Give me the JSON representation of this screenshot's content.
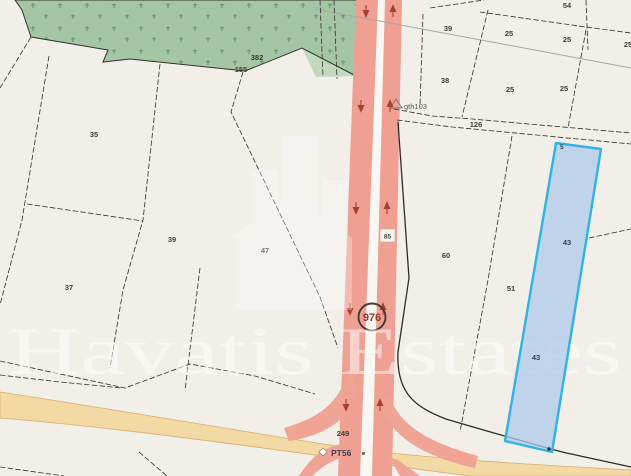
{
  "background_color": "#f2efe8",
  "watermark": {
    "text": "Havatis Estates"
  },
  "forest": {
    "area_number": "382",
    "boundary_number": "155",
    "color": "#a5c6a4"
  },
  "roads": {
    "route_badge": "976",
    "lane_ref": "85",
    "road_point_label": "PT56",
    "road_number": "249",
    "vertical_road_color": "#efa092",
    "horizontal_road_color": "#f3d9a4"
  },
  "survey": {
    "marker_label": "gth103"
  },
  "highlight": {
    "upper_number": "43",
    "lower_number": "43",
    "corner_number": "5",
    "fill": "#aecbec",
    "border": "#2fb3e6"
  },
  "parcels": [
    {
      "n": "35"
    },
    {
      "n": "39"
    },
    {
      "n": "47"
    },
    {
      "n": "37"
    },
    {
      "n": "54"
    },
    {
      "n": "39"
    },
    {
      "n": "25"
    },
    {
      "n": "25"
    },
    {
      "n": "25"
    },
    {
      "n": "38"
    },
    {
      "n": "25"
    },
    {
      "n": "25"
    },
    {
      "n": "126"
    },
    {
      "n": "60"
    },
    {
      "n": "51"
    }
  ]
}
